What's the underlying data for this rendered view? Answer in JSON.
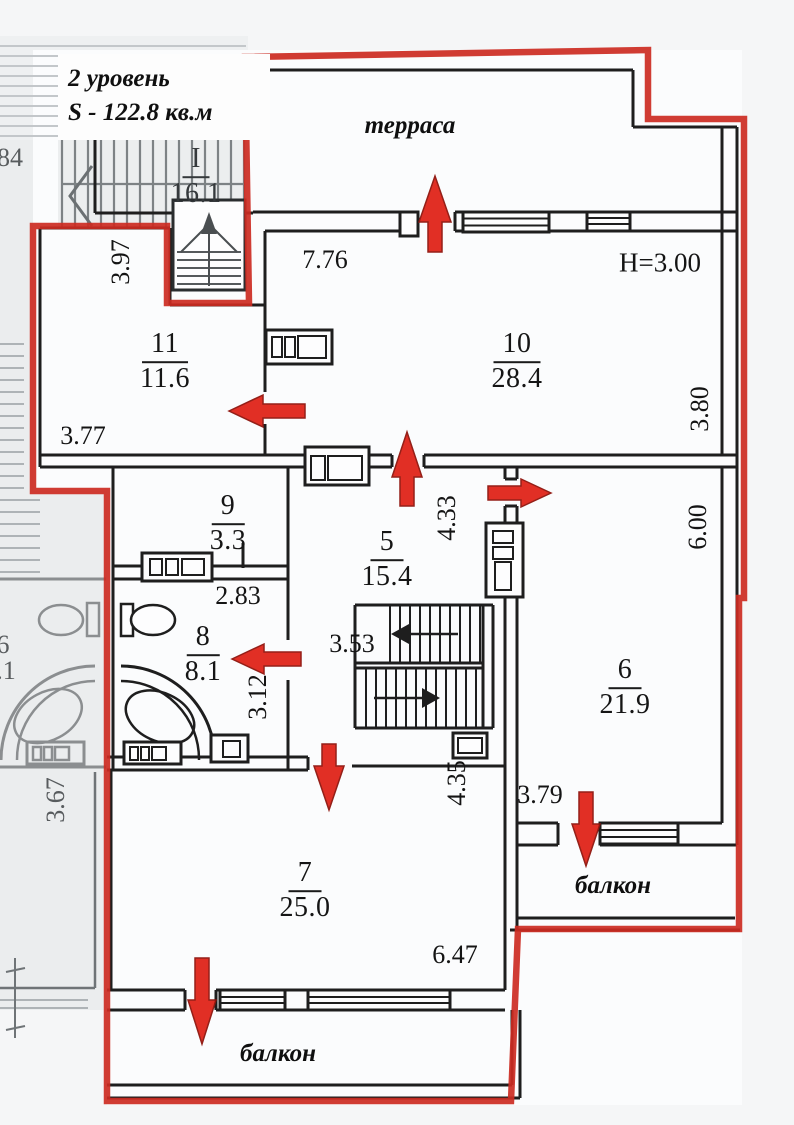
{
  "title": {
    "line1": "2 уровень",
    "line2": "S - 122.8 кв.м"
  },
  "area_labels": {
    "terrace": "терраса",
    "balcony_right": "балкон",
    "balcony_bottom": "балкон"
  },
  "height_note": "H=3.00",
  "rooms": {
    "r11": {
      "number": "11",
      "area": "11.6"
    },
    "r10": {
      "number": "10",
      "area": "28.4"
    },
    "r9": {
      "number": "9",
      "area": "3.3"
    },
    "r5": {
      "number": "5",
      "area": "15.4"
    },
    "r8": {
      "number": "8",
      "area": "8.1"
    },
    "r6": {
      "number": "6",
      "area": "21.9"
    },
    "r7": {
      "number": "7",
      "area": "25.0"
    },
    "stairwell": {
      "number": "I",
      "area": "16.1"
    }
  },
  "dimensions": {
    "terrace_front": "7.76",
    "room11_side": "3.97",
    "room11_width": "3.77",
    "room10_side": "3.80",
    "room5_side": "4.33",
    "hall_width": "2.83",
    "stair_hall_width": "3.53",
    "room8_side": "3.12",
    "room6_side": "6.00",
    "room7_side": "4.35",
    "room6_bottom": "3.79",
    "room7_width": "6.47",
    "neighbor_side": "3.67",
    "edge_partial": "84",
    "neighbor_number_partial": "6",
    "neighbor_area_partial": ".1"
  },
  "icons": {
    "entrance_arrows": [
      "up",
      "left",
      "up",
      "right",
      "left",
      "down",
      "down",
      "down"
    ],
    "stair_direction_arrows": [
      "left",
      "right",
      "up"
    ]
  },
  "colors": {
    "boundary_red": "#cc2b22",
    "arrow_red": "#e0251a",
    "wall_black": "#1e1e1e",
    "neighbor_grey": "#85898c"
  }
}
